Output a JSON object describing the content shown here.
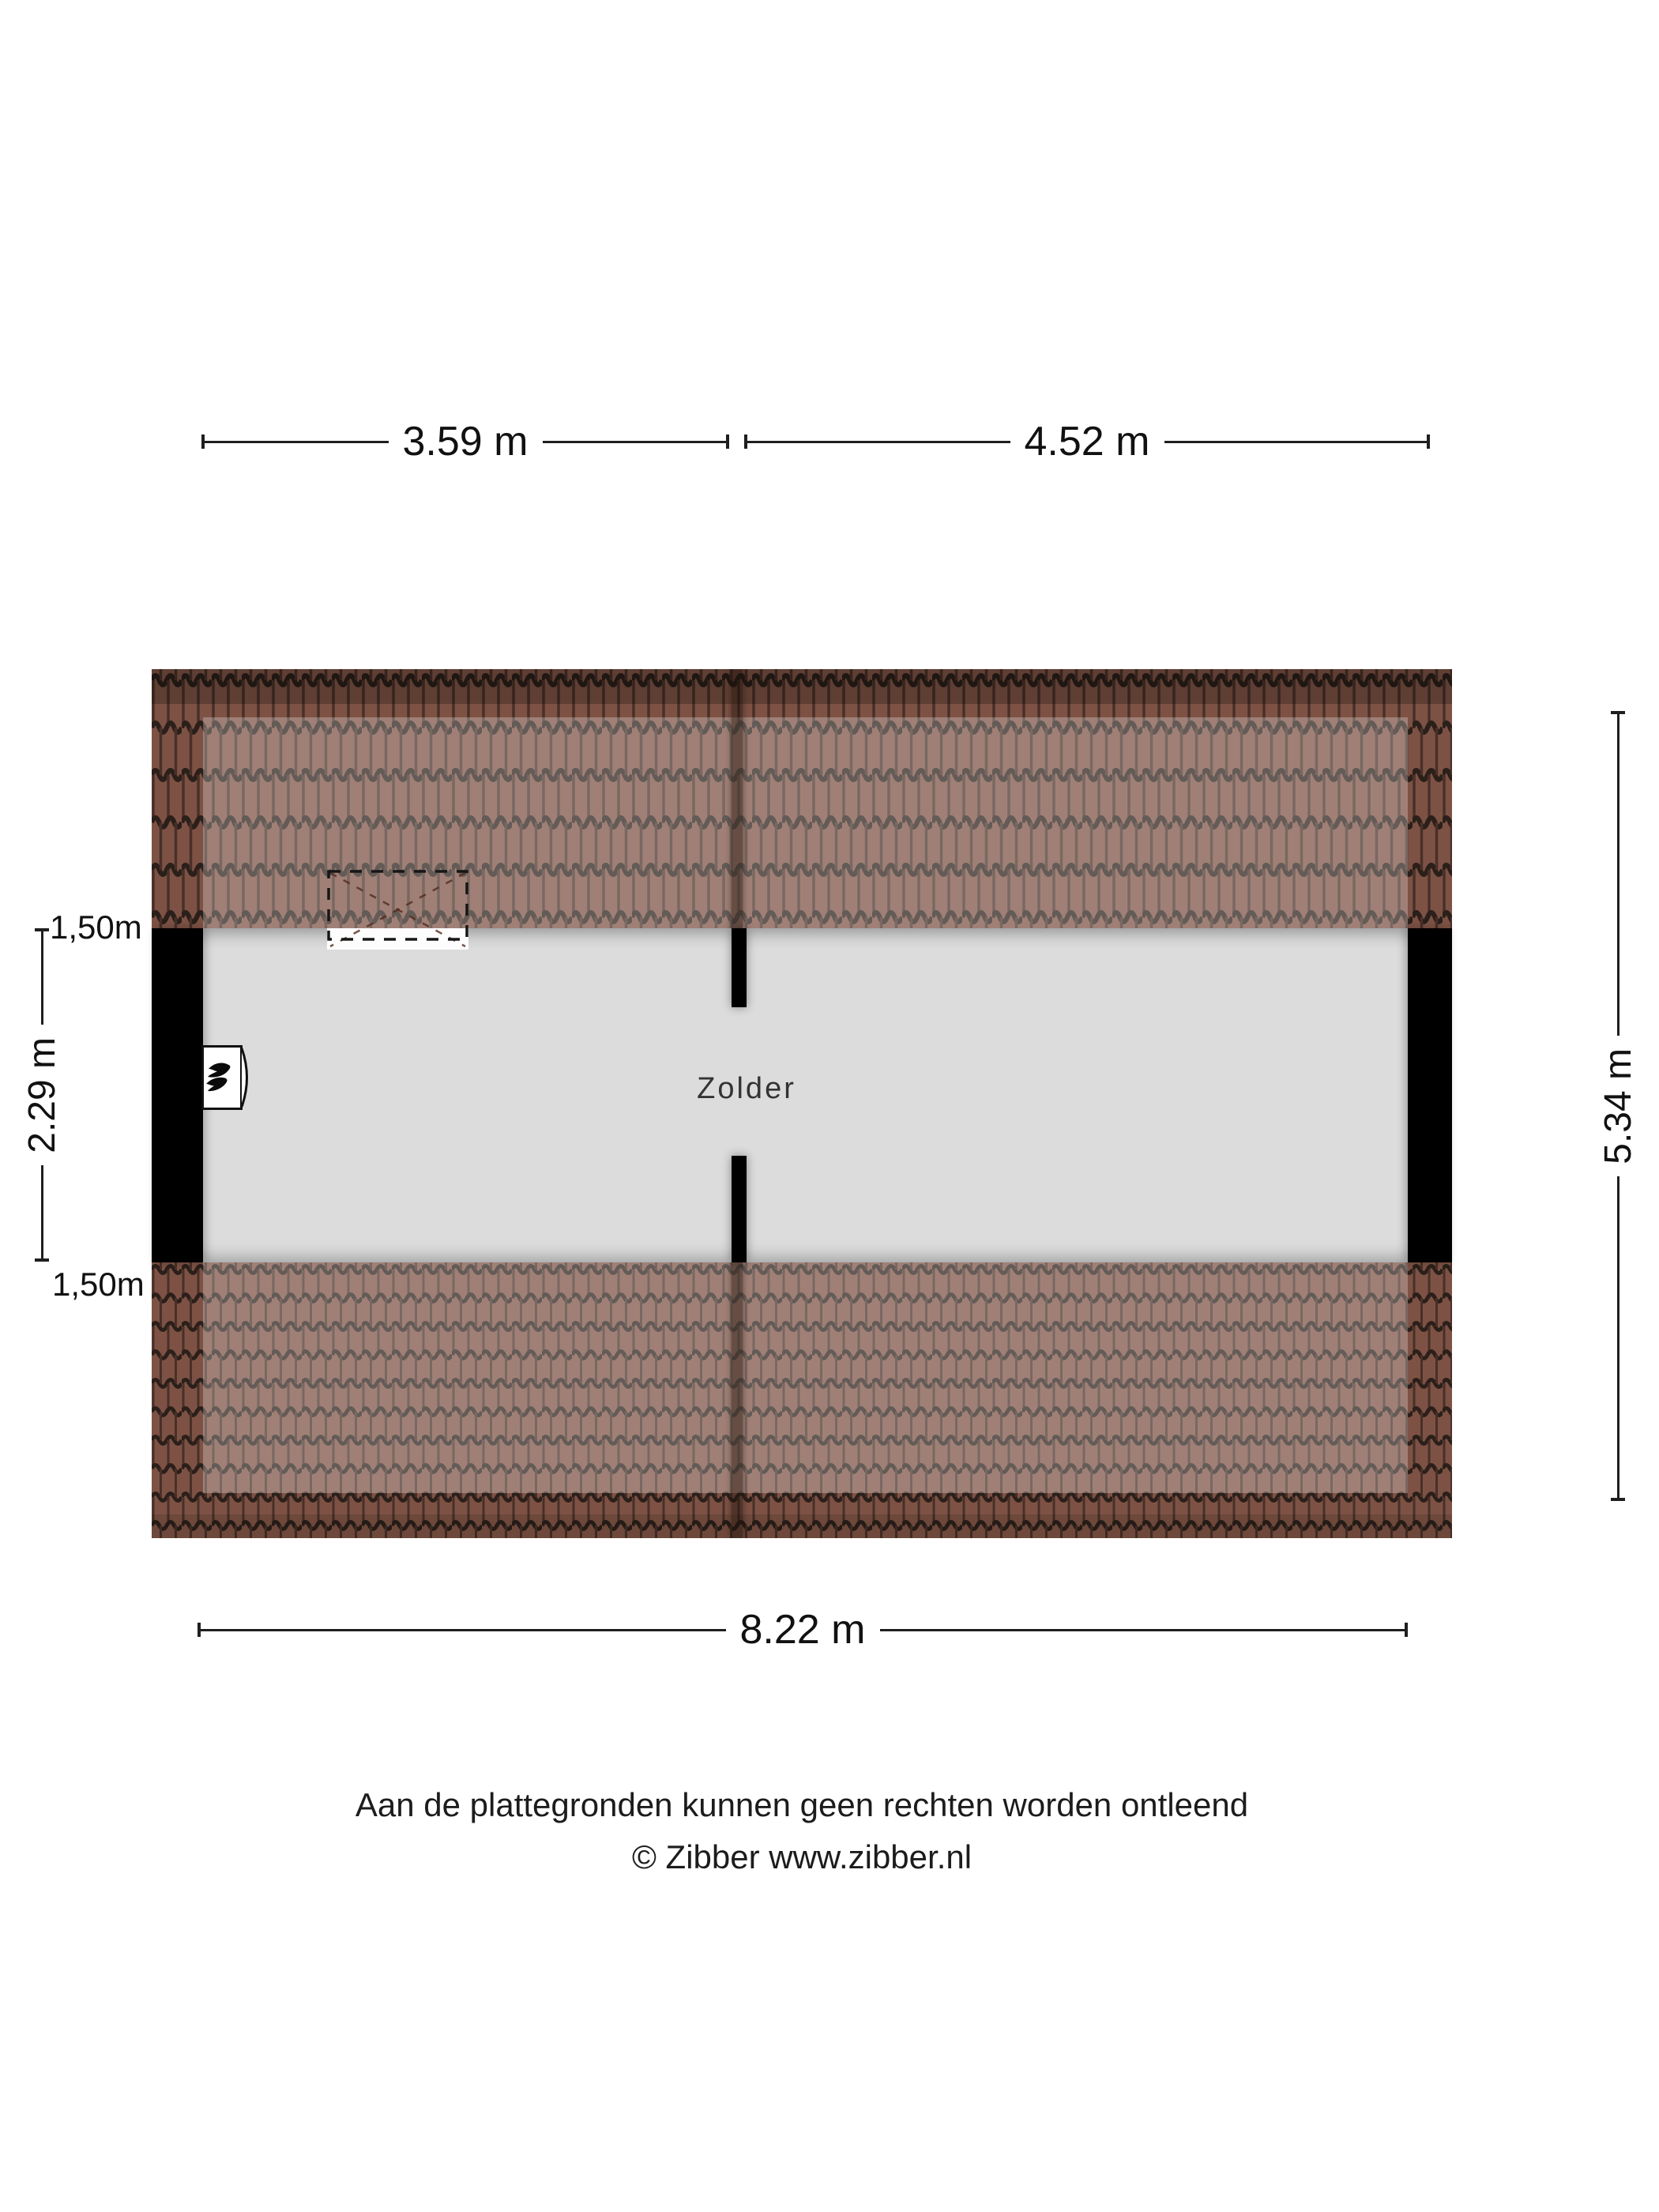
{
  "plan": {
    "room_label": "Zolder"
  },
  "dimensions": {
    "top_segments": [
      {
        "label": "3.59 m"
      },
      {
        "label": "4.52 m"
      }
    ],
    "bottom": {
      "label": "8.22 m"
    },
    "right": {
      "label": "5.34 m"
    },
    "left": {
      "upper_label": "1,50m",
      "span_label": "2.29 m",
      "lower_label": "1,50m"
    }
  },
  "footer": {
    "disclaimer": "Aan de plattegronden kunnen geen rechten worden ontleend",
    "credit": "© Zibber www.zibber.nl"
  },
  "colors": {
    "background": "#ffffff",
    "roof_tile": "#7d5244",
    "roof_tile_joint": "#2b1f1a",
    "roof_inner_overlay": "rgba(255,255,255,0.27)",
    "floor": "#dcdcdc",
    "wall": "#000000",
    "dimension_line": "#1f1f1f"
  },
  "icons": {
    "boiler": "flame-icon",
    "skylight": "roof-window-icon"
  }
}
